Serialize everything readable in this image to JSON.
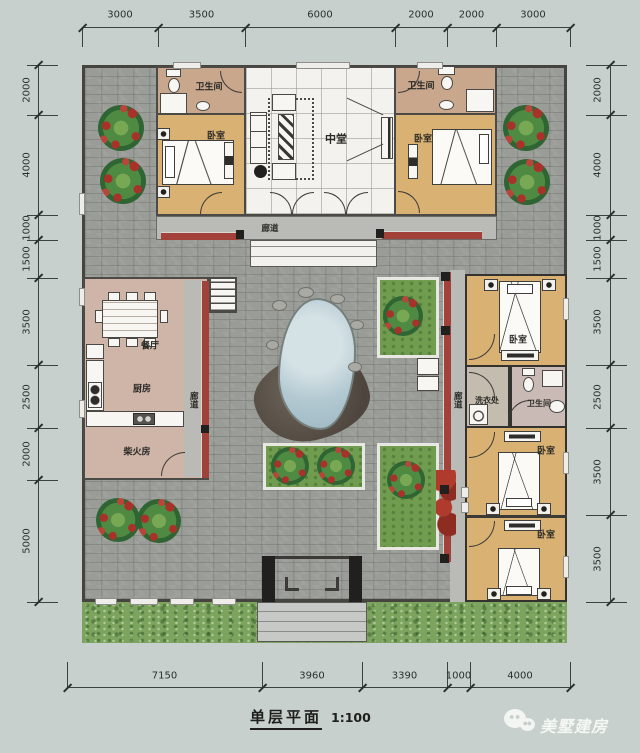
{
  "title": {
    "text": "单层平面",
    "scale": "1:100"
  },
  "watermark": {
    "brand": "美墅建房",
    "icon": "wechat-icon"
  },
  "colors": {
    "canvas": "#c7d0cc",
    "paving": "#9a9c98",
    "grass": "#7ca45e",
    "wall": "#4b4a46",
    "wallDark": "#33322e",
    "corridor": "#babbb6",
    "redStrip": "#a2413a",
    "bedroom": "#d8b173",
    "bathroom": "#c9a78c",
    "hall": "#f4f2ee",
    "kitchen": "#cfb5a8",
    "laundry": "#c4bcae",
    "bathroomEast": "#c9bab5",
    "planter": "#6f9c4e",
    "pond": "#b5c9d1",
    "rock": "#5e564e",
    "dimText": "#2b302e"
  },
  "dimensions": {
    "top": {
      "ticks": [
        82,
        158,
        245,
        395,
        447,
        496,
        570
      ],
      "labels": [
        "3000",
        "3500",
        "6000",
        "2000",
        "2000",
        "3000"
      ]
    },
    "bottom": {
      "ticks": [
        67,
        262,
        362,
        447,
        470,
        570
      ],
      "labels": [
        "7150",
        "3960",
        "3390",
        "1000",
        "4000"
      ]
    },
    "left": {
      "ticks": [
        65,
        115,
        215,
        240,
        278,
        365,
        428,
        480,
        602
      ],
      "labels": [
        "2000",
        "4000",
        "1000",
        "1500",
        "3500",
        "2500",
        "2000",
        "5000"
      ]
    },
    "right": {
      "ticks": [
        65,
        115,
        215,
        240,
        278,
        365,
        428,
        515,
        602
      ],
      "labels": [
        "2000",
        "4000",
        "1000",
        "1500",
        "3500",
        "2500",
        "3500",
        "3500"
      ]
    }
  },
  "rooms": [
    {
      "id": "bathroom-nw",
      "x": 156,
      "y": 66,
      "w": 91,
      "h": 49,
      "bg": "bathroom"
    },
    {
      "id": "bedroom-nw",
      "x": 156,
      "y": 113,
      "w": 91,
      "h": 103,
      "bg": "bedroom"
    },
    {
      "id": "main-hall",
      "x": 244,
      "y": 66,
      "w": 152,
      "h": 150,
      "bg": "hall",
      "grid": true
    },
    {
      "id": "bathroom-ne",
      "x": 394,
      "y": 66,
      "w": 103,
      "h": 49,
      "bg": "bathroom"
    },
    {
      "id": "bedroom-ne",
      "x": 394,
      "y": 113,
      "w": 103,
      "h": 103,
      "bg": "bedroom"
    },
    {
      "id": "corridor-north",
      "x": 156,
      "y": 216,
      "w": 341,
      "h": 24,
      "bg": "corridor",
      "thin": true
    },
    {
      "id": "west-wing-kitchen-block",
      "x": 83,
      "y": 277,
      "w": 126,
      "h": 203,
      "bg": "kitchen"
    },
    {
      "id": "corridor-west",
      "x": 184,
      "y": 280,
      "w": 17,
      "h": 197,
      "bg": "corridor",
      "noborder": true
    },
    {
      "id": "corridor-east",
      "x": 450,
      "y": 270,
      "w": 15,
      "h": 332,
      "bg": "corridor",
      "noborder": true
    },
    {
      "id": "east-wing-bedroom-block",
      "x": 465,
      "y": 274,
      "w": 102,
      "h": 328,
      "bg": "bedroom",
      "dark": true
    },
    {
      "id": "laundry",
      "x": 465,
      "y": 365,
      "w": 45,
      "h": 63,
      "bg": "laundry",
      "dark": true
    },
    {
      "id": "bathroom-east",
      "x": 510,
      "y": 365,
      "w": 57,
      "h": 63,
      "bg": "bathroomEast",
      "dark": true
    }
  ],
  "labels": [
    {
      "id": "bathroom-nw",
      "t": "卫生间",
      "x": 209,
      "y": 88
    },
    {
      "id": "bedroom-nw",
      "t": "卧室",
      "x": 216,
      "y": 137
    },
    {
      "id": "main-hall",
      "t": "中堂",
      "x": 336,
      "y": 139,
      "fs": 11
    },
    {
      "id": "bathroom-ne",
      "t": "卫生间",
      "x": 421,
      "y": 87
    },
    {
      "id": "bedroom-ne",
      "t": "卧室",
      "x": 423,
      "y": 140
    },
    {
      "id": "corridor-north",
      "t": "廊道",
      "x": 270,
      "y": 229,
      "fs": 8.5
    },
    {
      "id": "dining-room",
      "t": "餐厅",
      "x": 150,
      "y": 347
    },
    {
      "id": "kitchen",
      "t": "厨房",
      "x": 142,
      "y": 390
    },
    {
      "id": "corridor-west",
      "t": "廊道",
      "x": 193,
      "y": 400,
      "v": true,
      "fs": 8.5
    },
    {
      "id": "firewood-room",
      "t": "柴火房",
      "x": 137,
      "y": 453
    },
    {
      "id": "bedroom-e1",
      "t": "卧室",
      "x": 518,
      "y": 341
    },
    {
      "id": "laundry",
      "t": "洗衣处",
      "x": 487,
      "y": 401,
      "fs": 8
    },
    {
      "id": "bathroom-east",
      "t": "卫生间",
      "x": 539,
      "y": 404,
      "fs": 8
    },
    {
      "id": "corridor-east",
      "t": "廊道",
      "x": 457,
      "y": 400,
      "v": true,
      "fs": 8.5
    },
    {
      "id": "bedroom-e2",
      "t": "卧室",
      "x": 546,
      "y": 452
    },
    {
      "id": "bedroom-e3",
      "t": "卧室",
      "x": 546,
      "y": 536
    }
  ]
}
